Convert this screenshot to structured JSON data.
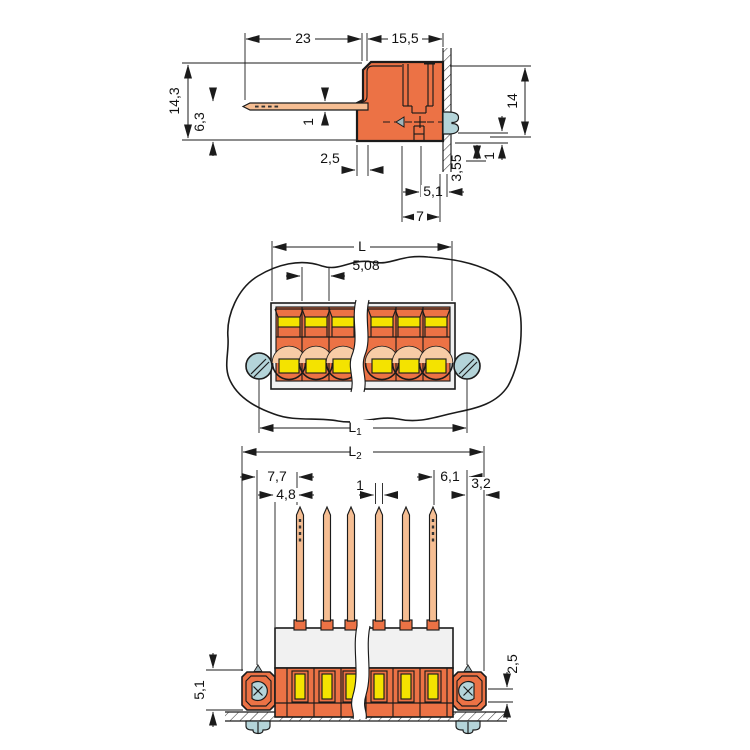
{
  "meta": {
    "type": "technical-dimension-drawing",
    "subject": "pluggable male header terminal block connector, three orthographic views with panel mounting",
    "units": "mm",
    "background": "#ffffff"
  },
  "colors": {
    "housing_orange": "#EC7245",
    "contact_yellow": "#F4E300",
    "screw_blue": "#B4D4D9",
    "pin_copper": "#F6BE93",
    "circle_highlight": "#F8CCA6",
    "frame_gray": "#F1F1F1",
    "marker_gray": "#9FB5BA",
    "line": "#1B1B1B"
  },
  "views": {
    "side": {
      "name": "side-view",
      "dims": {
        "pin_length": "23",
        "housing_depth": "15,5",
        "total_height": "14,3",
        "pin_height": "6,3",
        "pin_thickness": "1",
        "step": "2,5",
        "housing_height": "14",
        "panel_clearance": "1",
        "panel_depth": "3,55",
        "screw_offset": "5,1",
        "recess_depth": "7"
      }
    },
    "front": {
      "name": "front-view",
      "dims": {
        "length": "L",
        "pitch": "5,08",
        "l1_main": "L",
        "l1_sub": "1",
        "l2_main": "L",
        "l2_sub": "2"
      }
    },
    "bottom": {
      "name": "pin-side-view",
      "dims": {
        "edge_to_pin": "7,7",
        "body_to_pin": "4,8",
        "pin_width": "1",
        "pin_to_screw": "6,1",
        "screw_to_edge": "3,2",
        "flange_height": "5,1",
        "flange_offset": "2,5"
      }
    }
  }
}
